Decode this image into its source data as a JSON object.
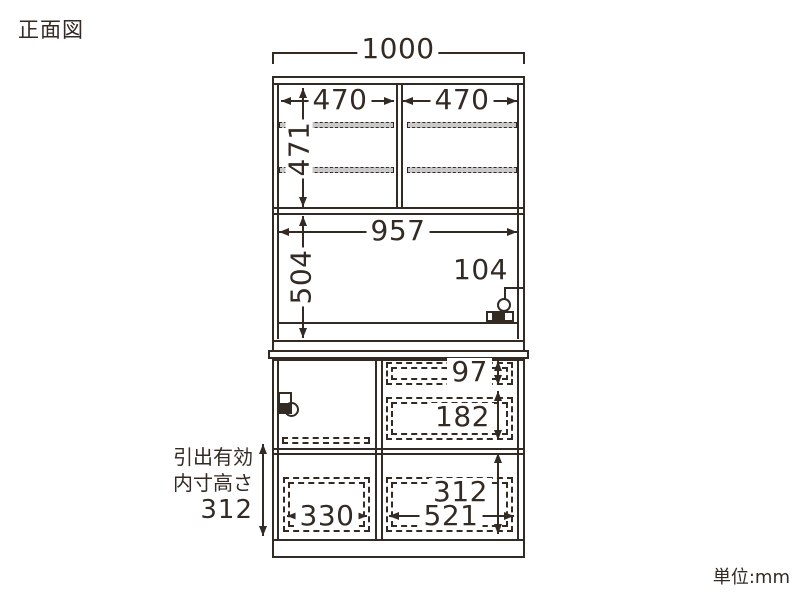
{
  "title": "正面図",
  "unit_label": "単位:mm",
  "drawer_note": {
    "line1": "引出有効",
    "line2": "内寸高さ",
    "value": "312"
  },
  "dimensions": {
    "overall_width": "1000",
    "left_door_width": "470",
    "right_door_width": "470",
    "upper_inner_height": "471",
    "open_inner_width": "957",
    "open_inner_height": "504",
    "outlet_offset": "104",
    "upper_drawer_height": "97",
    "middle_drawer_height": "182",
    "left_drawer_width": "330",
    "right_drawer_width": "521",
    "drawer_inner_height": "312"
  },
  "icons": {
    "outlet": "outlet-icon",
    "door_handle": "door-handle-icon"
  },
  "colors": {
    "ink": "#332a24",
    "shelf_fill": "#c9c9c9",
    "background": "#ffffff"
  }
}
